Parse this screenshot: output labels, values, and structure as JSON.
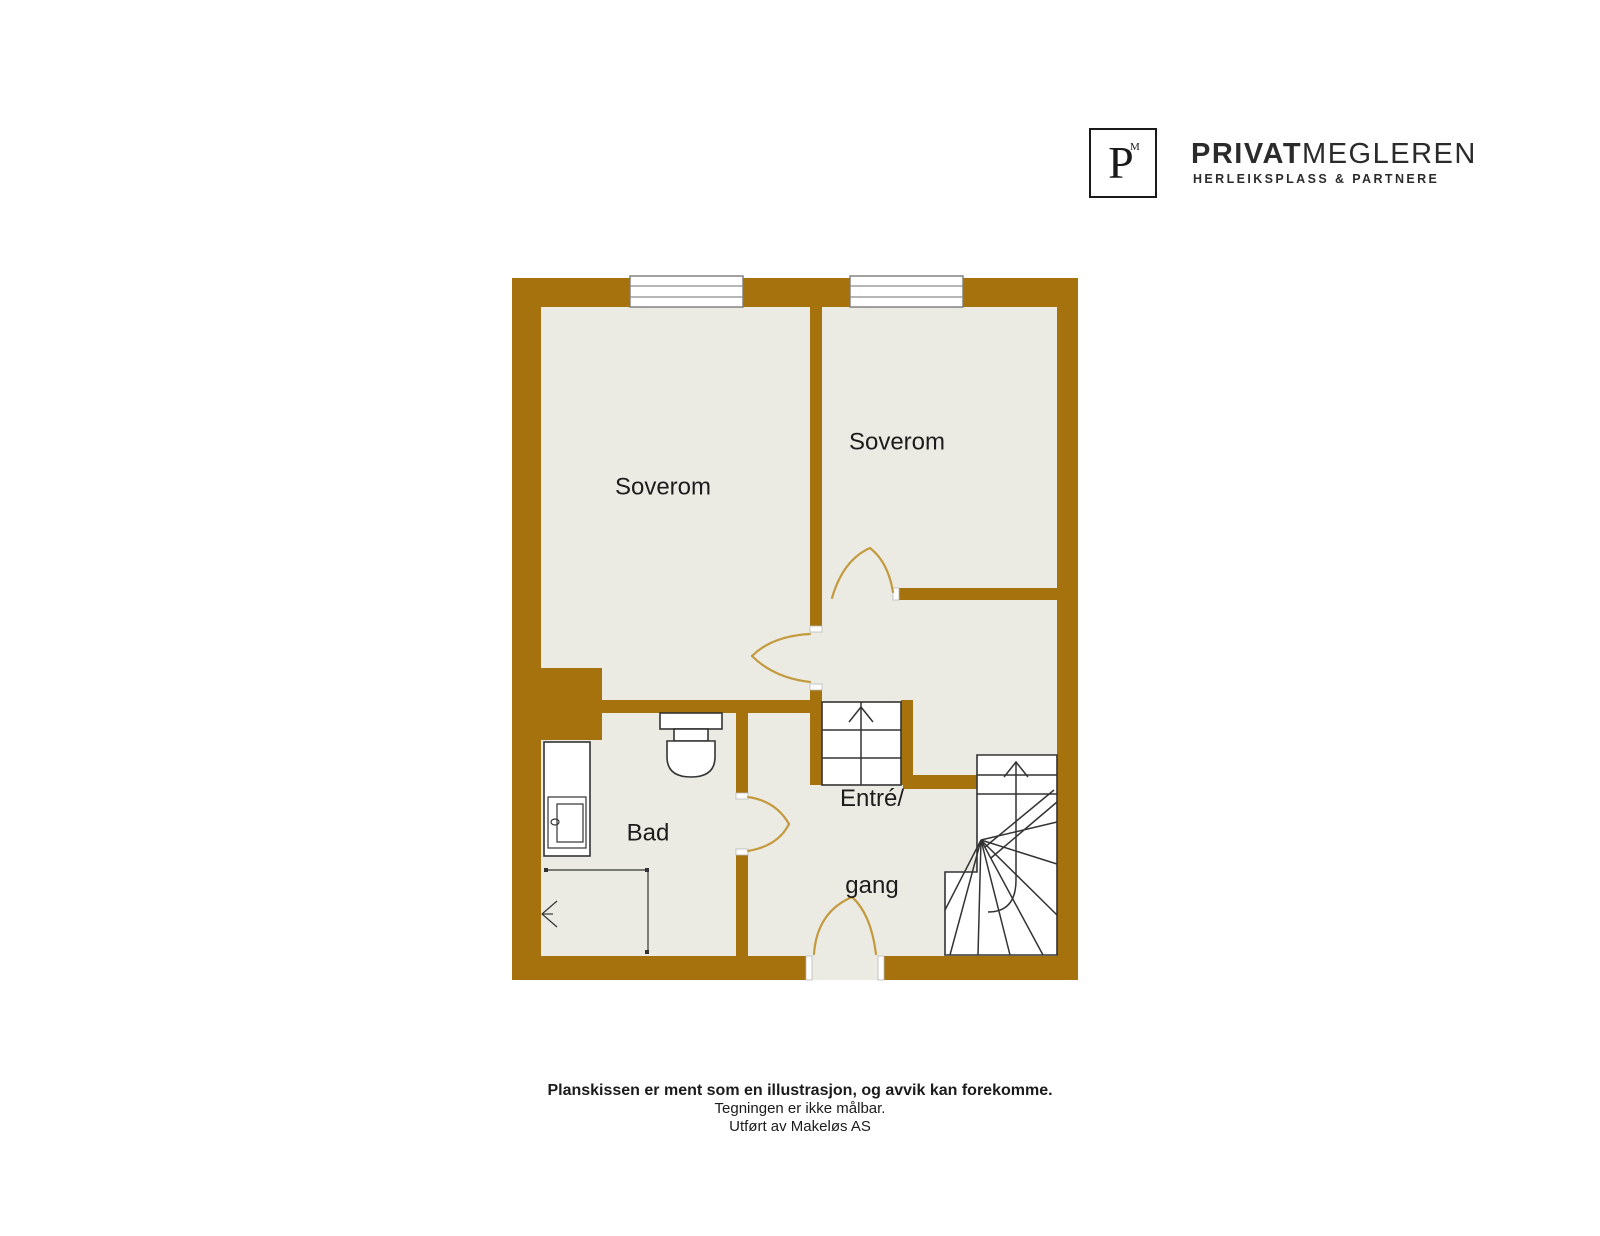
{
  "logo": {
    "monogram": "P",
    "monogram_sup": "M",
    "brand_bold": "PRIVAT",
    "brand_light": "MEGLEREN",
    "subtitle": "HERLEIKSPLASS & PARTNERE"
  },
  "floorplan": {
    "rooms": [
      {
        "id": "soverom-1",
        "label": "Soverom"
      },
      {
        "id": "soverom-2",
        "label": "Soverom"
      },
      {
        "id": "bad",
        "label": "Bad"
      },
      {
        "id": "entre-gang",
        "label_line1": "Entré/",
        "label_line2": "gang"
      }
    ],
    "features": [
      "window",
      "window",
      "straight-staircase-up",
      "curved-staircase-up",
      "toilet",
      "sink-cabinet",
      "shower-corner",
      "entrance-door"
    ],
    "colors": {
      "wall": "#a5720d",
      "floor": "#ebebe4",
      "door_swing": "#c49a3e",
      "line": "#333333"
    }
  },
  "footer": {
    "line1": "Planskissen er ment som en illustrasjon, og avvik kan forekomme.",
    "line2": "Tegningen er ikke målbar.",
    "line3": "Utført av Makeløs AS"
  }
}
